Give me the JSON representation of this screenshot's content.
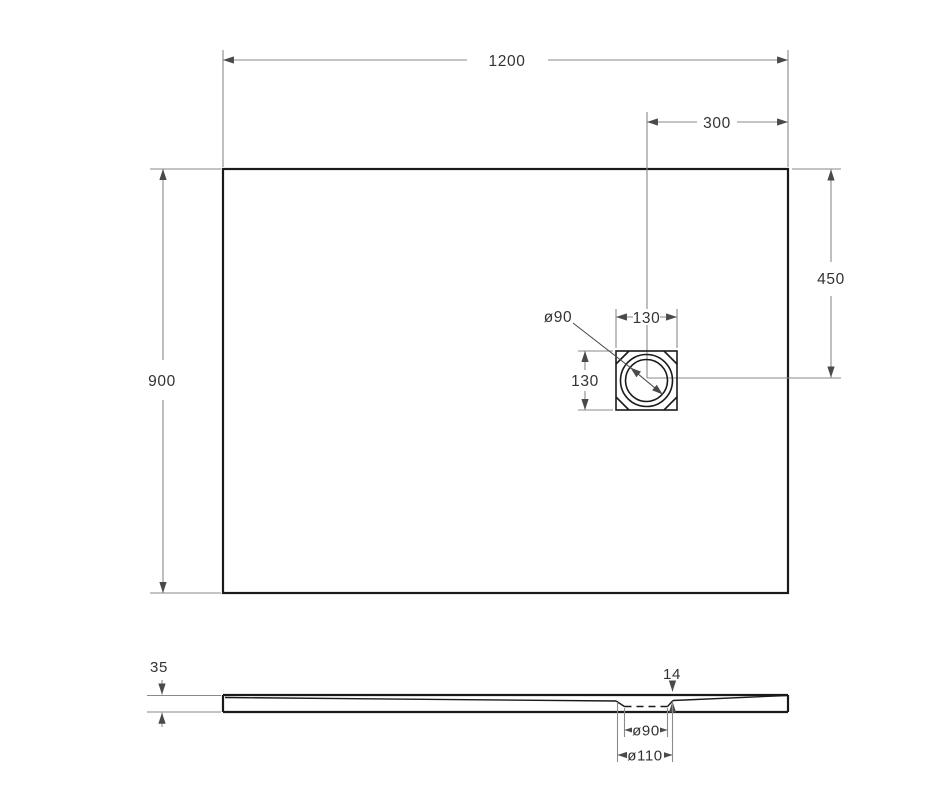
{
  "drawing": {
    "title": "shower-tray-dimension-drawing",
    "colors": {
      "outline": "#1a1a1a",
      "dimension_line": "#8a8a8a",
      "dimension_text": "#333333",
      "background": "#ffffff"
    },
    "top_view": {
      "width_label": "1200",
      "height_label": "900",
      "drain_offset_right_label": "300",
      "drain_offset_vertical_label": "450",
      "drain_box_width_label": "130",
      "drain_box_height_label": "130",
      "drain_diameter_label": "ø90"
    },
    "side_view": {
      "thickness_label": "35",
      "drain_recess_depth_label": "14",
      "drain_hole_diameter_label": "ø90",
      "drain_recess_diameter_label": "ø110"
    }
  }
}
